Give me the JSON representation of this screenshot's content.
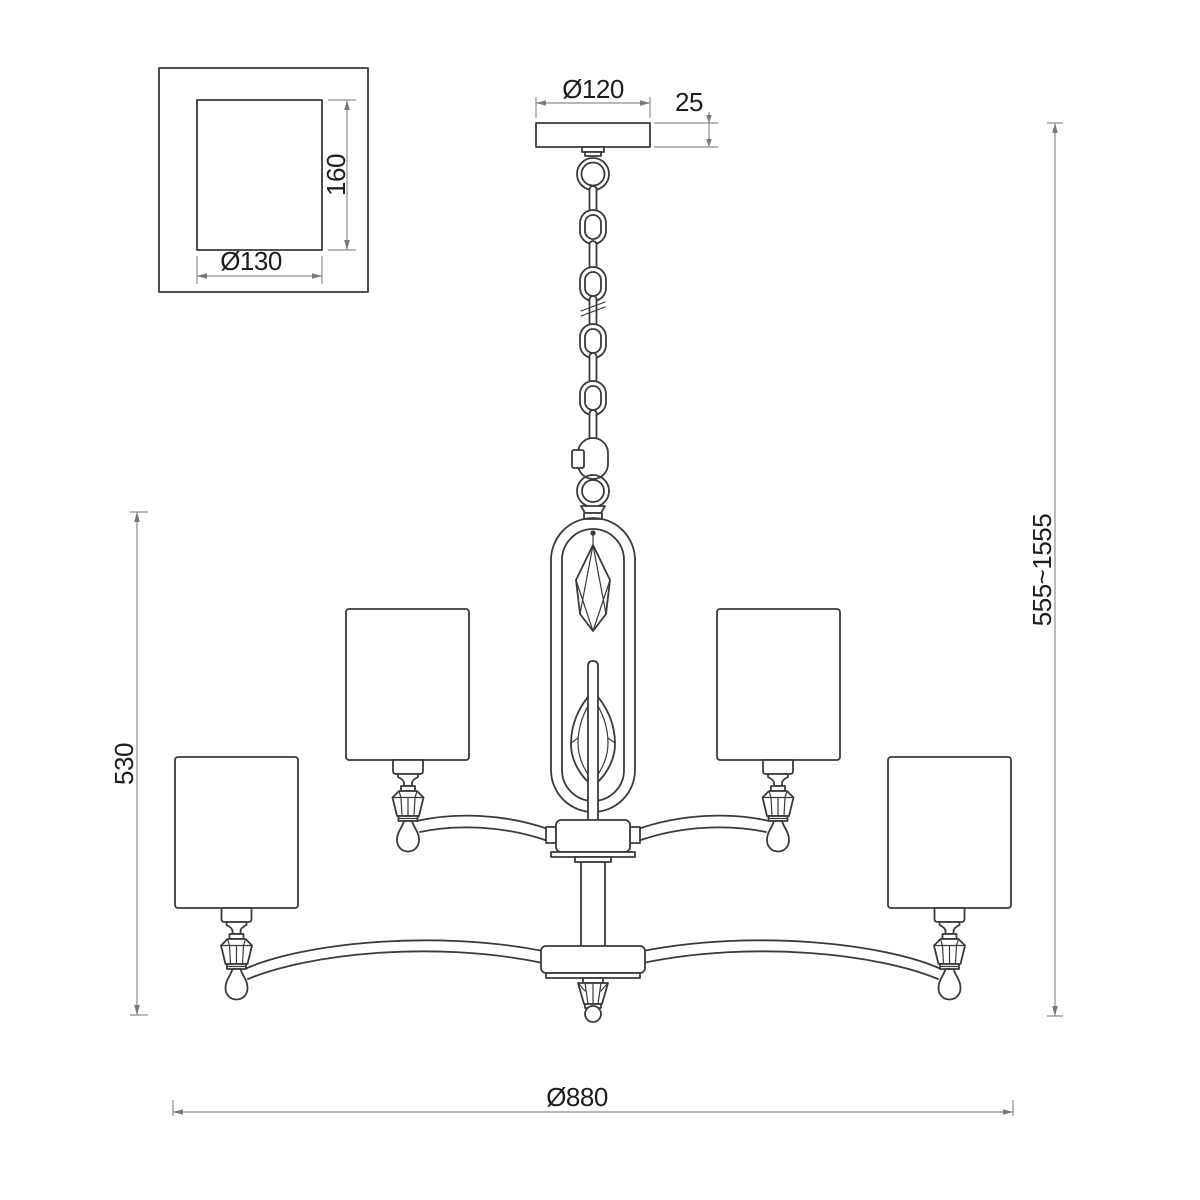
{
  "document": {
    "background": "#ffffff",
    "description": "Technical dimension drawing of a two-tier four-arm chandelier with drum shades, chain suspension, ceiling canopy detail view, and an oval centre frame holding crystal drops"
  },
  "colors": {
    "outline": "#3a3a3a",
    "dimension_line": "#8e8e8e",
    "dimension_arrow": "#777777",
    "dimension_text": "#1d1d1d"
  },
  "labels": {
    "detail_height": "160",
    "detail_diameter": "Ø130",
    "canopy_diameter": "Ø120",
    "canopy_thickness": "25",
    "body_height": "530",
    "overall_height": "555~1555",
    "overall_diameter": "Ø880"
  }
}
